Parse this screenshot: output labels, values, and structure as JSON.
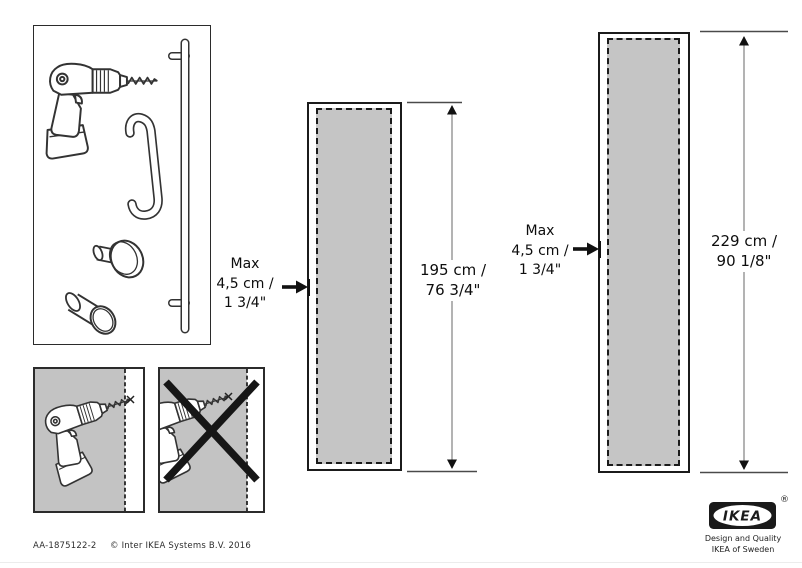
{
  "document": {
    "doc_id": "AA-1875122-2",
    "copyright": "© Inter IKEA Systems B.V. 2016"
  },
  "branding": {
    "logo_text": "IKEA",
    "registered_mark": "®",
    "tagline_line1": "Design and Quality",
    "tagline_line2": "IKEA of Sweden",
    "logo_color": "#1a1a1a"
  },
  "colors": {
    "background": "#ffffff",
    "door_fill": "#c5c5c5",
    "panel_fill": "#c3c3c3",
    "outline": "#1c1c1c"
  },
  "illustrations": {
    "parts_box": [
      "drill",
      "door-pull-handle",
      "long-rail-handle",
      "round-knob",
      "cylinder-knob"
    ],
    "correct_panel": "drill-within-edge-zone",
    "incorrect_panel": "drill-outside-edge-zone-crossed-out"
  },
  "doors": [
    {
      "name": "door-195",
      "max_label": {
        "line1": "Max",
        "line2": "4,5 cm /",
        "line3": "1 3/4\""
      },
      "height": {
        "line1": "195 cm /",
        "line2": "76 3/4\""
      }
    },
    {
      "name": "door-229",
      "max_label": {
        "line1": "Max",
        "line2": "4,5 cm /",
        "line3": "1 3/4\""
      },
      "height": {
        "line1": "229 cm /",
        "line2": "90 1/8\""
      }
    }
  ]
}
